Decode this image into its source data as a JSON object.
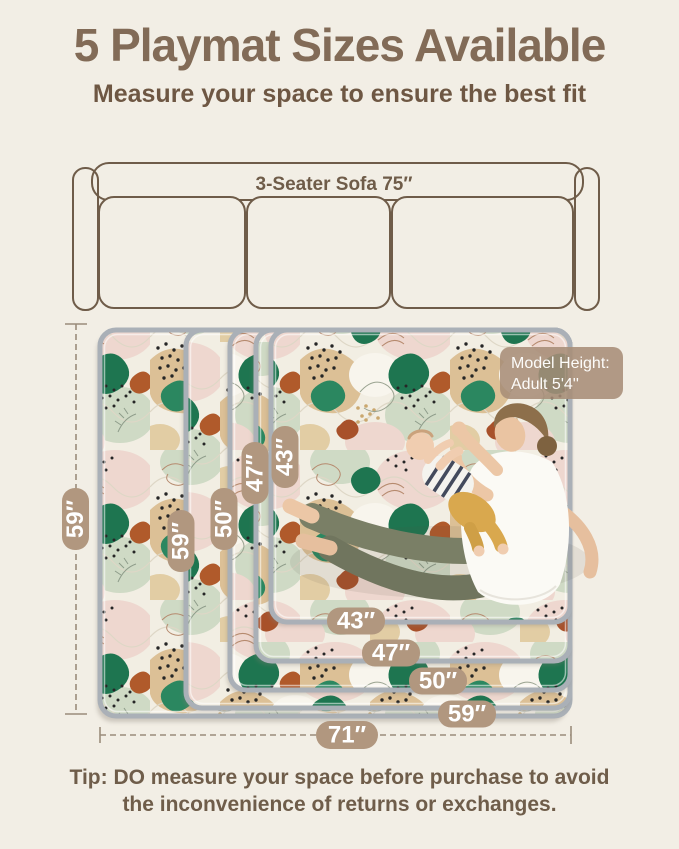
{
  "title": "5 Playmat Sizes Available",
  "subtitle": "Measure your space to ensure the best fit",
  "sofa": {
    "label": "3-Seater Sofa 75″"
  },
  "model_badge": {
    "line1": "Model Height:",
    "line2": "Adult  5'4''"
  },
  "dimensions": {
    "outer_height": "59″",
    "outer_width": "71″",
    "mat_heights": [
      "59″",
      "50″",
      "47″",
      "43″"
    ],
    "mat_widths": [
      "43″",
      "47″",
      "50″",
      "59″"
    ]
  },
  "tip": {
    "line1": "Tip: DO measure your space before purchase to avoid",
    "line2": "the inconvenience of returns or exchanges."
  },
  "colors": {
    "background": "#f2eee5",
    "title": "#826b57",
    "subtitle": "#6e5743",
    "badge": "#b1977f",
    "model_badge": "#a78d77",
    "sofa_outline": "#6f5c49",
    "dimension_line": "#9a8c7b",
    "mat_border": "#aab0b7",
    "tip_text": "#6f5d4a"
  }
}
